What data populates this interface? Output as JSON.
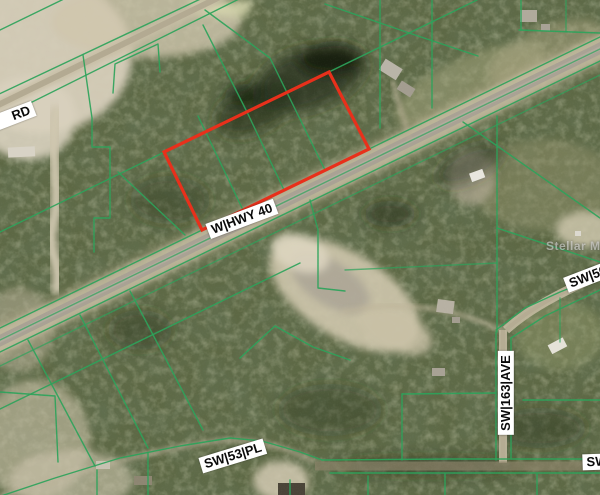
{
  "map": {
    "road_labels": {
      "rd": "RD",
      "w_hwy_40": "W|HWY 40",
      "sw_50": "SW|50",
      "sw_163_ave": "SW|163|AVE",
      "sw_53_pl": "SW|53|PL",
      "sw_partial": "SW"
    },
    "watermark": "Stellar MLS",
    "selected_parcel": {
      "outline_color": "#e8301b",
      "corners_px": [
        [
          164,
          152
        ],
        [
          329,
          72
        ],
        [
          369,
          149
        ],
        [
          202,
          230
        ]
      ]
    },
    "colors": {
      "parcel_line_green": "#2ba35a",
      "selected_parcel_red": "#e8301b",
      "road_label_bg": "#ffffff",
      "road_label_text": "#0a0a0a",
      "highway_pavement": "#a9a294",
      "dirt_sand": "#d2c9b2",
      "forest_base": "#5d6844"
    }
  }
}
